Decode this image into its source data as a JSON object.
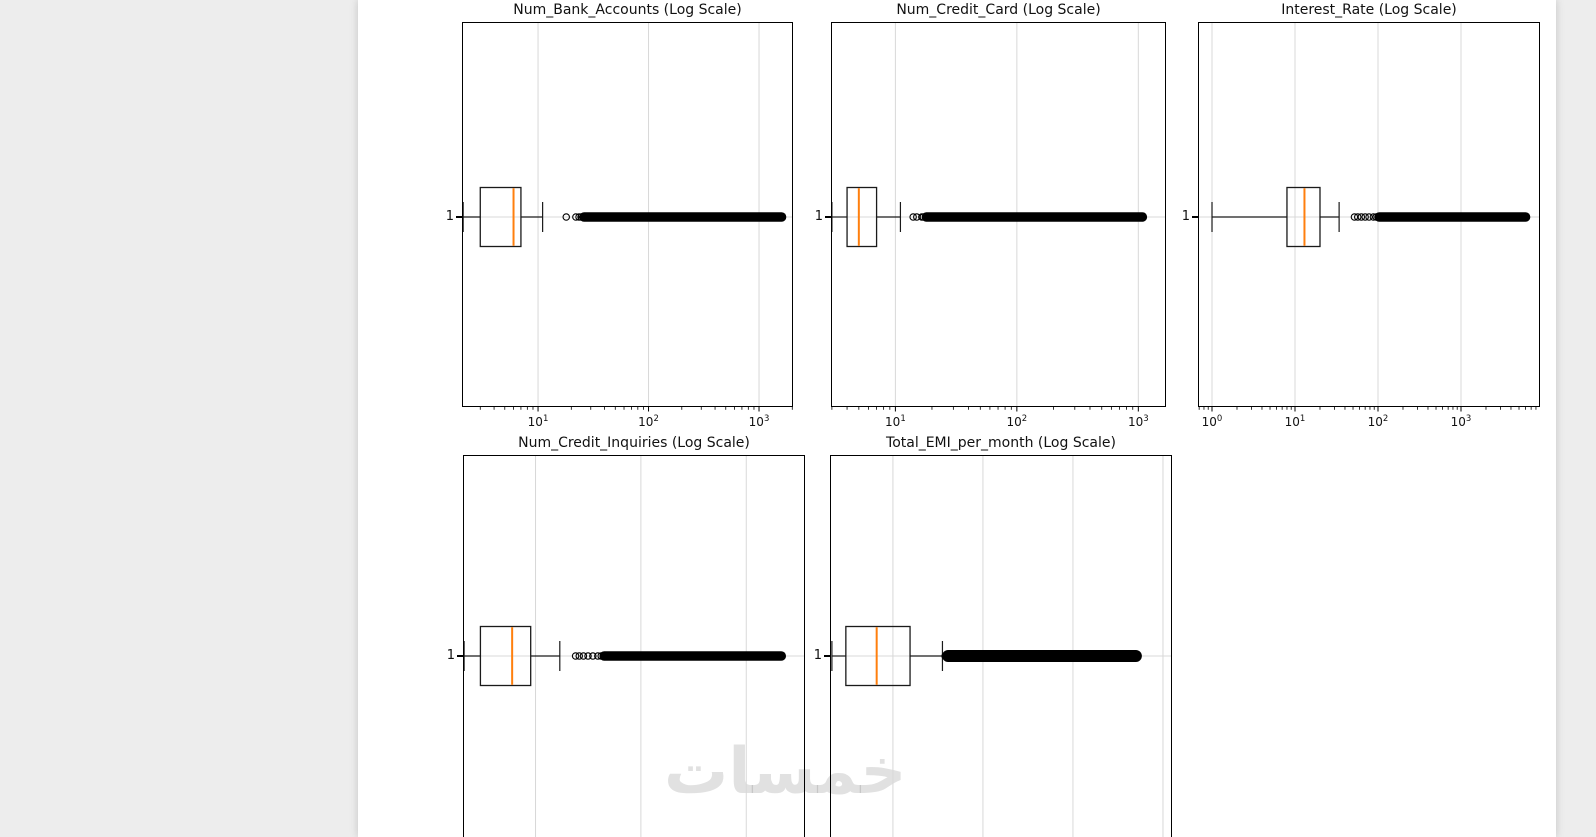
{
  "watermark": {
    "text": "خمسات"
  },
  "colors": {
    "page_background": "#ffffff",
    "margin_background": "#ededed",
    "median_line": "#ff7f0e",
    "gridline": "#d8d8d8",
    "box_edge": "#1a1a1a",
    "spine": "#000000",
    "outlier": "#000000",
    "text": "#111111",
    "watermark": "#e3e3e3"
  },
  "chart_data": [
    {
      "type": "boxplot",
      "orientation": "horizontal",
      "title": "Num_Bank_Accounts (Log Scale)",
      "x_scale": "log",
      "xlim": [
        2.05,
        2030
      ],
      "x_ticks": [
        {
          "value": 10,
          "label_base": "10",
          "label_exp": "1"
        },
        {
          "value": 100,
          "label_base": "10",
          "label_exp": "2"
        },
        {
          "value": 1000,
          "label_base": "10",
          "label_exp": "3"
        }
      ],
      "x_tick_labels_visible": true,
      "y_category": "1",
      "grid": true,
      "stats": {
        "whisker_low": 2.1,
        "q1": 3,
        "median": 6,
        "q3": 7,
        "whisker_high": 11
      },
      "outliers": [
        18,
        22,
        23.5
      ],
      "outlier_band_range": [
        24.5,
        1600
      ]
    },
    {
      "type": "boxplot",
      "orientation": "horizontal",
      "title": "Num_Credit_Card (Log Scale)",
      "x_scale": "log",
      "xlim": [
        2.95,
        1690
      ],
      "x_ticks": [
        {
          "value": 10,
          "label_base": "10",
          "label_exp": "1"
        },
        {
          "value": 100,
          "label_base": "10",
          "label_exp": "2"
        },
        {
          "value": 1000,
          "label_base": "10",
          "label_exp": "3"
        }
      ],
      "x_tick_labels_visible": true,
      "y_category": "1",
      "grid": true,
      "stats": {
        "whisker_low": 3,
        "q1": 4,
        "median": 5,
        "q3": 7,
        "whisker_high": 11
      },
      "outliers": [
        14,
        15,
        16.5
      ],
      "outlier_band_range": [
        17,
        1080
      ]
    },
    {
      "type": "boxplot",
      "orientation": "horizontal",
      "title": "Interest_Rate (Log Scale)",
      "x_scale": "log",
      "xlim": [
        0.678,
        8950
      ],
      "x_ticks": [
        {
          "value": 1,
          "label_base": "10",
          "label_exp": "0"
        },
        {
          "value": 10,
          "label_base": "10",
          "label_exp": "1"
        },
        {
          "value": 100,
          "label_base": "10",
          "label_exp": "2"
        },
        {
          "value": 1000,
          "label_base": "10",
          "label_exp": "3"
        }
      ],
      "x_tick_labels_visible": true,
      "y_category": "1",
      "grid": true,
      "stats": {
        "whisker_low": 1,
        "q1": 8,
        "median": 13,
        "q3": 20,
        "whisker_high": 34
      },
      "outliers": [
        52,
        57,
        63,
        70,
        78,
        88
      ],
      "outlier_band_range": [
        95,
        6000
      ]
    },
    {
      "type": "boxplot",
      "orientation": "horizontal",
      "title": "Num_Credit_Inquiries (Log Scale)",
      "x_scale": "log",
      "xlim": [
        2.05,
        3610
      ],
      "x_ticks": [
        {
          "value": 10,
          "label_base": "10",
          "label_exp": "1"
        },
        {
          "value": 100,
          "label_base": "10",
          "label_exp": "2"
        },
        {
          "value": 1000,
          "label_base": "10",
          "label_exp": "3"
        }
      ],
      "x_tick_labels_visible": false,
      "y_category": "1",
      "grid": true,
      "stats": {
        "whisker_low": 2.1,
        "q1": 3,
        "median": 6,
        "q3": 9,
        "whisker_high": 17
      },
      "outliers": [
        24,
        26,
        28.5,
        31.5,
        35,
        39
      ],
      "outlier_band_range": [
        42,
        2150
      ]
    },
    {
      "type": "boxplot",
      "orientation": "horizontal",
      "title": "Total_EMI_per_month (Log Scale)",
      "x_scale": "log",
      "xlim": [
        20,
        126000
      ],
      "x_ticks": [
        {
          "value": 100,
          "label_base": "10",
          "label_exp": "2"
        },
        {
          "value": 1000,
          "label_base": "10",
          "label_exp": "3"
        },
        {
          "value": 10000,
          "label_base": "10",
          "label_exp": "4"
        },
        {
          "value": 100000,
          "label_base": "10",
          "label_exp": "5"
        }
      ],
      "x_tick_labels_visible": false,
      "y_category": "1",
      "grid": true,
      "stats": {
        "whisker_low": 21,
        "q1": 30,
        "median": 66,
        "q3": 155,
        "whisker_high": 355
      },
      "outliers": [],
      "outlier_band_range": [
        380,
        50000
      ]
    }
  ]
}
